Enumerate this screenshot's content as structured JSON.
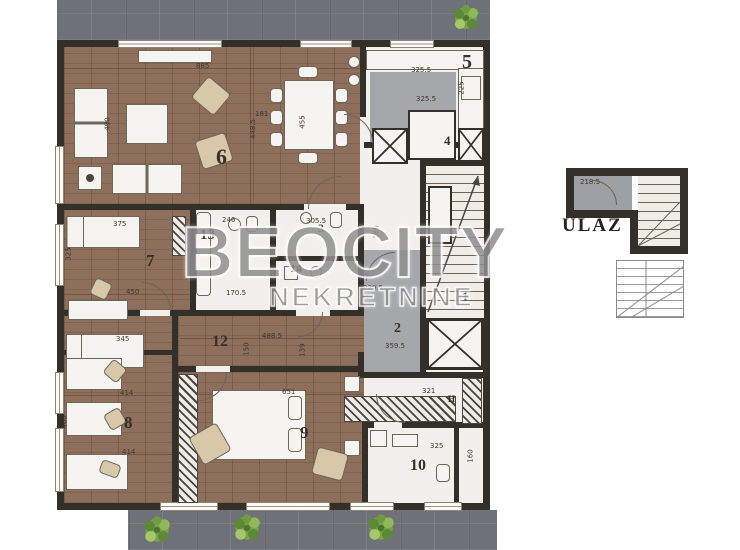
{
  "title": "apartment-floor-plan",
  "watermark": {
    "line1": "BEOCITY",
    "line2": "NEKRETNINE"
  },
  "entrance": {
    "label": "ULAZ"
  },
  "colors": {
    "wall": "#33302a",
    "wood_floor": "#8d6f5b",
    "terrace_gray": "#6e7177",
    "gray_floor": "#a6a7ab",
    "room_white": "#f2f0ec",
    "plant_green": "#79a348",
    "watermark_gray": "#8f8f8f"
  },
  "room_numbers": [
    {
      "label": "6",
      "x": 216,
      "y": 146,
      "size": 22
    },
    {
      "label": "5",
      "x": 462,
      "y": 52,
      "size": 20
    },
    {
      "label": "4",
      "x": 444,
      "y": 134,
      "size": 13
    },
    {
      "label": "1",
      "x": 462,
      "y": 290,
      "size": 13
    },
    {
      "label": "7",
      "x": 146,
      "y": 252,
      "size": 17
    },
    {
      "label": "13",
      "x": 200,
      "y": 228,
      "size": 15
    },
    {
      "label": "3",
      "x": 318,
      "y": 222,
      "size": 12
    },
    {
      "label": "14",
      "x": 290,
      "y": 262,
      "size": 12
    },
    {
      "label": "2",
      "x": 394,
      "y": 322,
      "size": 14
    },
    {
      "label": "12",
      "x": 212,
      "y": 334,
      "size": 16
    },
    {
      "label": "8",
      "x": 124,
      "y": 414,
      "size": 17
    },
    {
      "label": "9",
      "x": 300,
      "y": 424,
      "size": 17
    },
    {
      "label": "10",
      "x": 410,
      "y": 458,
      "size": 16
    },
    {
      "label": "H",
      "x": 448,
      "y": 395,
      "size": 9
    }
  ],
  "dimensions": [
    {
      "text": "885",
      "x": 196,
      "y": 62
    },
    {
      "text": "490",
      "x": 101,
      "y": 120,
      "v": 1
    },
    {
      "text": "448.5",
      "x": 243,
      "y": 125,
      "v": 1
    },
    {
      "text": "181",
      "x": 255,
      "y": 110
    },
    {
      "text": "455",
      "x": 296,
      "y": 118,
      "v": 1
    },
    {
      "text": "325.5",
      "x": 411,
      "y": 66
    },
    {
      "text": "325.5",
      "x": 416,
      "y": 95
    },
    {
      "text": "225",
      "x": 455,
      "y": 84,
      "v": 1
    },
    {
      "text": "375",
      "x": 113,
      "y": 220
    },
    {
      "text": "325",
      "x": 62,
      "y": 250,
      "v": 1
    },
    {
      "text": "450",
      "x": 126,
      "y": 288
    },
    {
      "text": "246",
      "x": 222,
      "y": 216
    },
    {
      "text": "170.5",
      "x": 226,
      "y": 289
    },
    {
      "text": "305.5",
      "x": 306,
      "y": 217
    },
    {
      "text": "220.5",
      "x": 363,
      "y": 284
    },
    {
      "text": "359.5",
      "x": 385,
      "y": 342
    },
    {
      "text": "160",
      "x": 370,
      "y": 228,
      "v": 1
    },
    {
      "text": "345",
      "x": 116,
      "y": 335
    },
    {
      "text": "488.5",
      "x": 262,
      "y": 332
    },
    {
      "text": "150",
      "x": 240,
      "y": 345,
      "v": 1
    },
    {
      "text": "139",
      "x": 296,
      "y": 346,
      "v": 1
    },
    {
      "text": "414",
      "x": 120,
      "y": 389
    },
    {
      "text": "414",
      "x": 122,
      "y": 448
    },
    {
      "text": "460",
      "x": 58,
      "y": 418,
      "v": 1
    },
    {
      "text": "651",
      "x": 282,
      "y": 388
    },
    {
      "text": "321",
      "x": 422,
      "y": 387
    },
    {
      "text": "325",
      "x": 430,
      "y": 442
    },
    {
      "text": "160",
      "x": 464,
      "y": 452,
      "v": 1
    },
    {
      "text": "218.5",
      "x": 580,
      "y": 178
    }
  ]
}
